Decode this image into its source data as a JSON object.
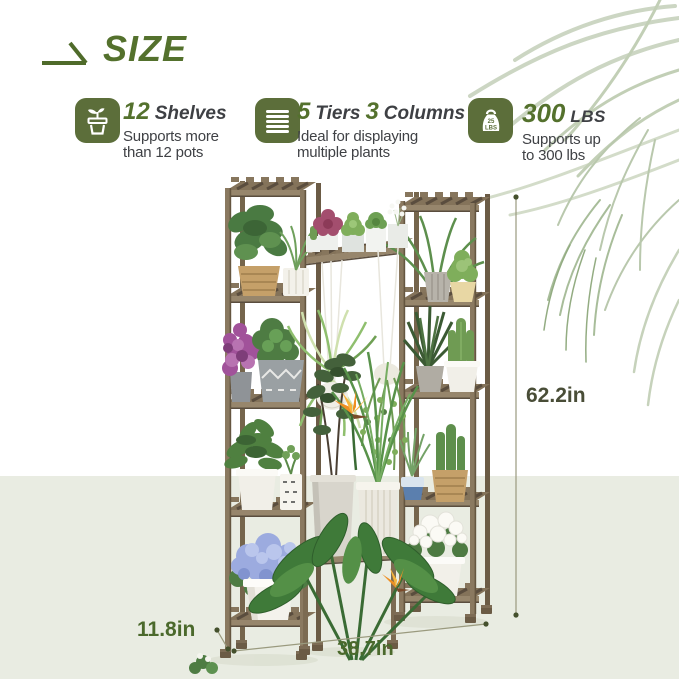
{
  "colors": {
    "accent_green": "#54712d",
    "icon_bg": "#5c6e3a",
    "dark_text": "#3e4044",
    "dimension_green": "#4b692c",
    "dimension_dark": "#494d37",
    "floor_bg": "#e9ece2"
  },
  "header": {
    "title": "SIZE",
    "icon": "swoosh-arrow-icon"
  },
  "features": [
    {
      "icon": "plant-pot-sprout-icon",
      "num": "12",
      "word": "Shelves",
      "desc1": "Supports more",
      "desc2": "than 12 pots"
    },
    {
      "icon": "stacked-tiers-icon",
      "num": "5",
      "word": "Tiers",
      "num2": "3",
      "word2": "Columns",
      "desc1": "Ideal for displaying",
      "desc2": "multiple plants"
    },
    {
      "icon": "weight-icon",
      "icon_line1": "25",
      "icon_line2": "LBS",
      "num": "300",
      "word": "LBS",
      "desc1": "Supports up",
      "desc2": "to 300 lbs"
    }
  ],
  "dimensions": {
    "height": "62.2in",
    "depth": "11.8in",
    "width": "38.7in"
  }
}
